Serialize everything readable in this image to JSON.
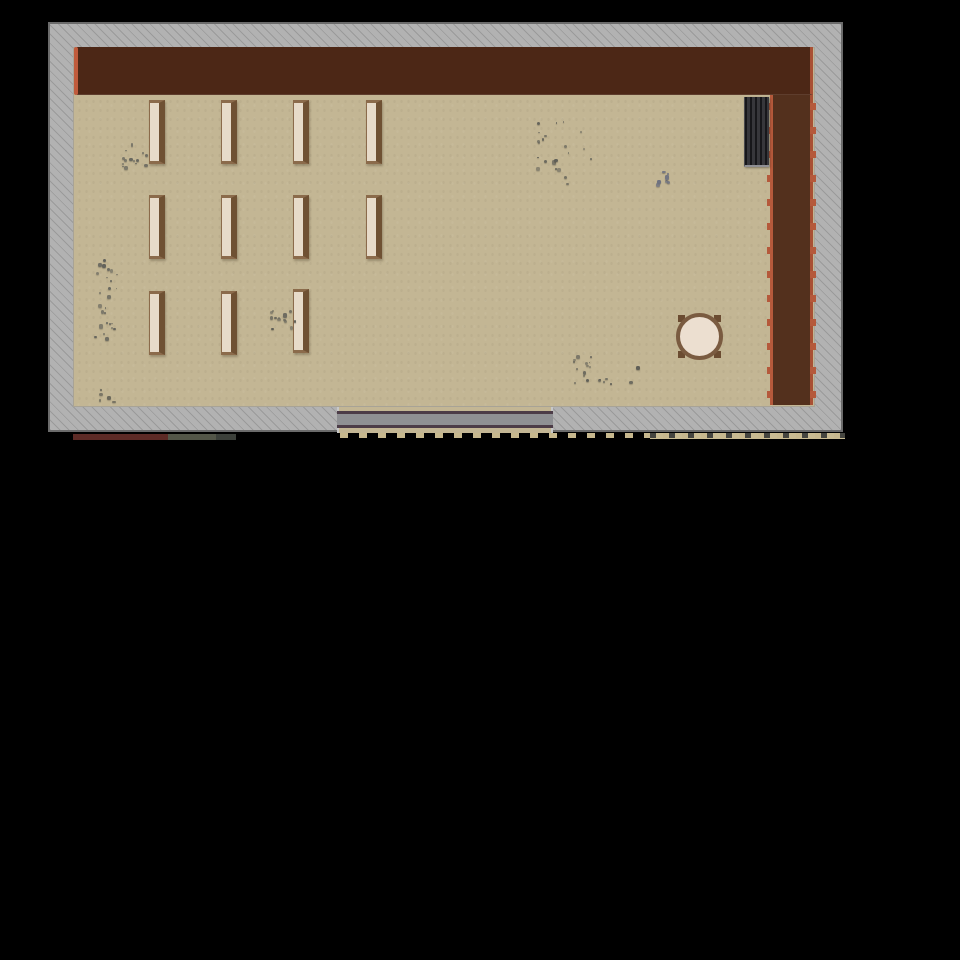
{
  "scene": {
    "type": "top-down-game-map",
    "canvas": {
      "width": 960,
      "height": 960
    },
    "background": "#000000"
  },
  "colors": {
    "wall_bg": "#b2b2b2",
    "wall_hatch": "#9a9a9a",
    "wall_border": "#6b6b6b",
    "floor": "#c3b694",
    "stage": "#4c2716",
    "stage_accent": "#c05b3c",
    "curtain": "#53301d",
    "curtain_edge": "#b5593b",
    "bench_face": "#e7dbc9",
    "bench_frame": "#8b6b4b",
    "bench_back": "#6f5133",
    "table_face": "#ecdfd0",
    "table_frame": "#7a5b40",
    "table_leg": "#6b4c31",
    "piano_dark": "#28282b",
    "piano_stripe": "#17171a",
    "piano_light": "#8f8f93",
    "door_bar": "#8f9093",
    "door_frame": "#4c3c47"
  },
  "room": {
    "outer_wall": {
      "x": 48,
      "y": 22,
      "w": 795,
      "h": 410
    },
    "floor": {
      "x": 73,
      "y": 47,
      "w": 742,
      "h": 360
    },
    "stage_band": {
      "x": 77,
      "y": 47,
      "w": 736,
      "h": 48
    },
    "stage_accent": {
      "x": 74,
      "y": 47,
      "w": 4,
      "h": 48
    },
    "curtain_right": {
      "x": 770,
      "y": 95,
      "w": 43,
      "h": 310
    },
    "curtain_bumps_left": {
      "x": 767,
      "y": 103,
      "w": 6,
      "h": 302
    },
    "curtain_bumps_right": {
      "x": 810,
      "y": 103,
      "w": 6,
      "h": 302
    },
    "door_gap": {
      "x": 337,
      "y": 407,
      "w": 216,
      "h": 26
    }
  },
  "furniture": {
    "bench_size": {
      "w": 16,
      "h": 64
    },
    "benches": [
      {
        "x": 149,
        "y": 100
      },
      {
        "x": 221,
        "y": 100
      },
      {
        "x": 293,
        "y": 100
      },
      {
        "x": 366,
        "y": 100
      },
      {
        "x": 149,
        "y": 195
      },
      {
        "x": 221,
        "y": 195
      },
      {
        "x": 293,
        "y": 195
      },
      {
        "x": 366,
        "y": 195
      },
      {
        "x": 149,
        "y": 291
      },
      {
        "x": 221,
        "y": 291
      },
      {
        "x": 293,
        "y": 289
      }
    ],
    "piano": {
      "x": 744,
      "y": 97,
      "w": 25,
      "h": 70
    },
    "round_table": {
      "x": 676,
      "y": 313,
      "w": 47,
      "h": 47
    },
    "entrance_door": {
      "x": 337,
      "y": 411,
      "w": 216,
      "h": 17
    }
  },
  "debris_clusters": [
    {
      "x": 120,
      "y": 142,
      "w": 34,
      "h": 32,
      "count": 14,
      "color": "#63635c",
      "seed": 11
    },
    {
      "x": 530,
      "y": 118,
      "w": 64,
      "h": 78,
      "count": 22,
      "color": "#5d5d56",
      "seed": 22
    },
    {
      "x": 652,
      "y": 168,
      "w": 22,
      "h": 24,
      "count": 8,
      "color": "#6d7180",
      "seed": 33
    },
    {
      "x": 94,
      "y": 256,
      "w": 30,
      "h": 86,
      "count": 26,
      "color": "#60605a",
      "seed": 44
    },
    {
      "x": 262,
      "y": 308,
      "w": 36,
      "h": 30,
      "count": 13,
      "color": "#5d5d56",
      "seed": 55
    },
    {
      "x": 573,
      "y": 355,
      "w": 68,
      "h": 32,
      "count": 20,
      "color": "#5b5b54",
      "seed": 66
    },
    {
      "x": 98,
      "y": 388,
      "w": 20,
      "h": 20,
      "count": 5,
      "color": "#4f4f49",
      "seed": 77
    }
  ],
  "bottom_fragments": [
    {
      "x": 73,
      "y": 434,
      "w": 95,
      "h": 6,
      "color": "#5d2b26"
    },
    {
      "x": 168,
      "y": 434,
      "w": 48,
      "h": 6,
      "color": "#535648"
    },
    {
      "x": 216,
      "y": 434,
      "w": 20,
      "h": 6,
      "color": "#3c403a"
    },
    {
      "x": 650,
      "y": 433,
      "w": 195,
      "h": 6,
      "color": "#c9bb92"
    }
  ],
  "bottom_dashes": {
    "light": {
      "x": 340,
      "y": 433,
      "w": 505,
      "h": 5
    },
    "dark": {
      "x": 650,
      "y": 433,
      "w": 195,
      "h": 5
    }
  }
}
